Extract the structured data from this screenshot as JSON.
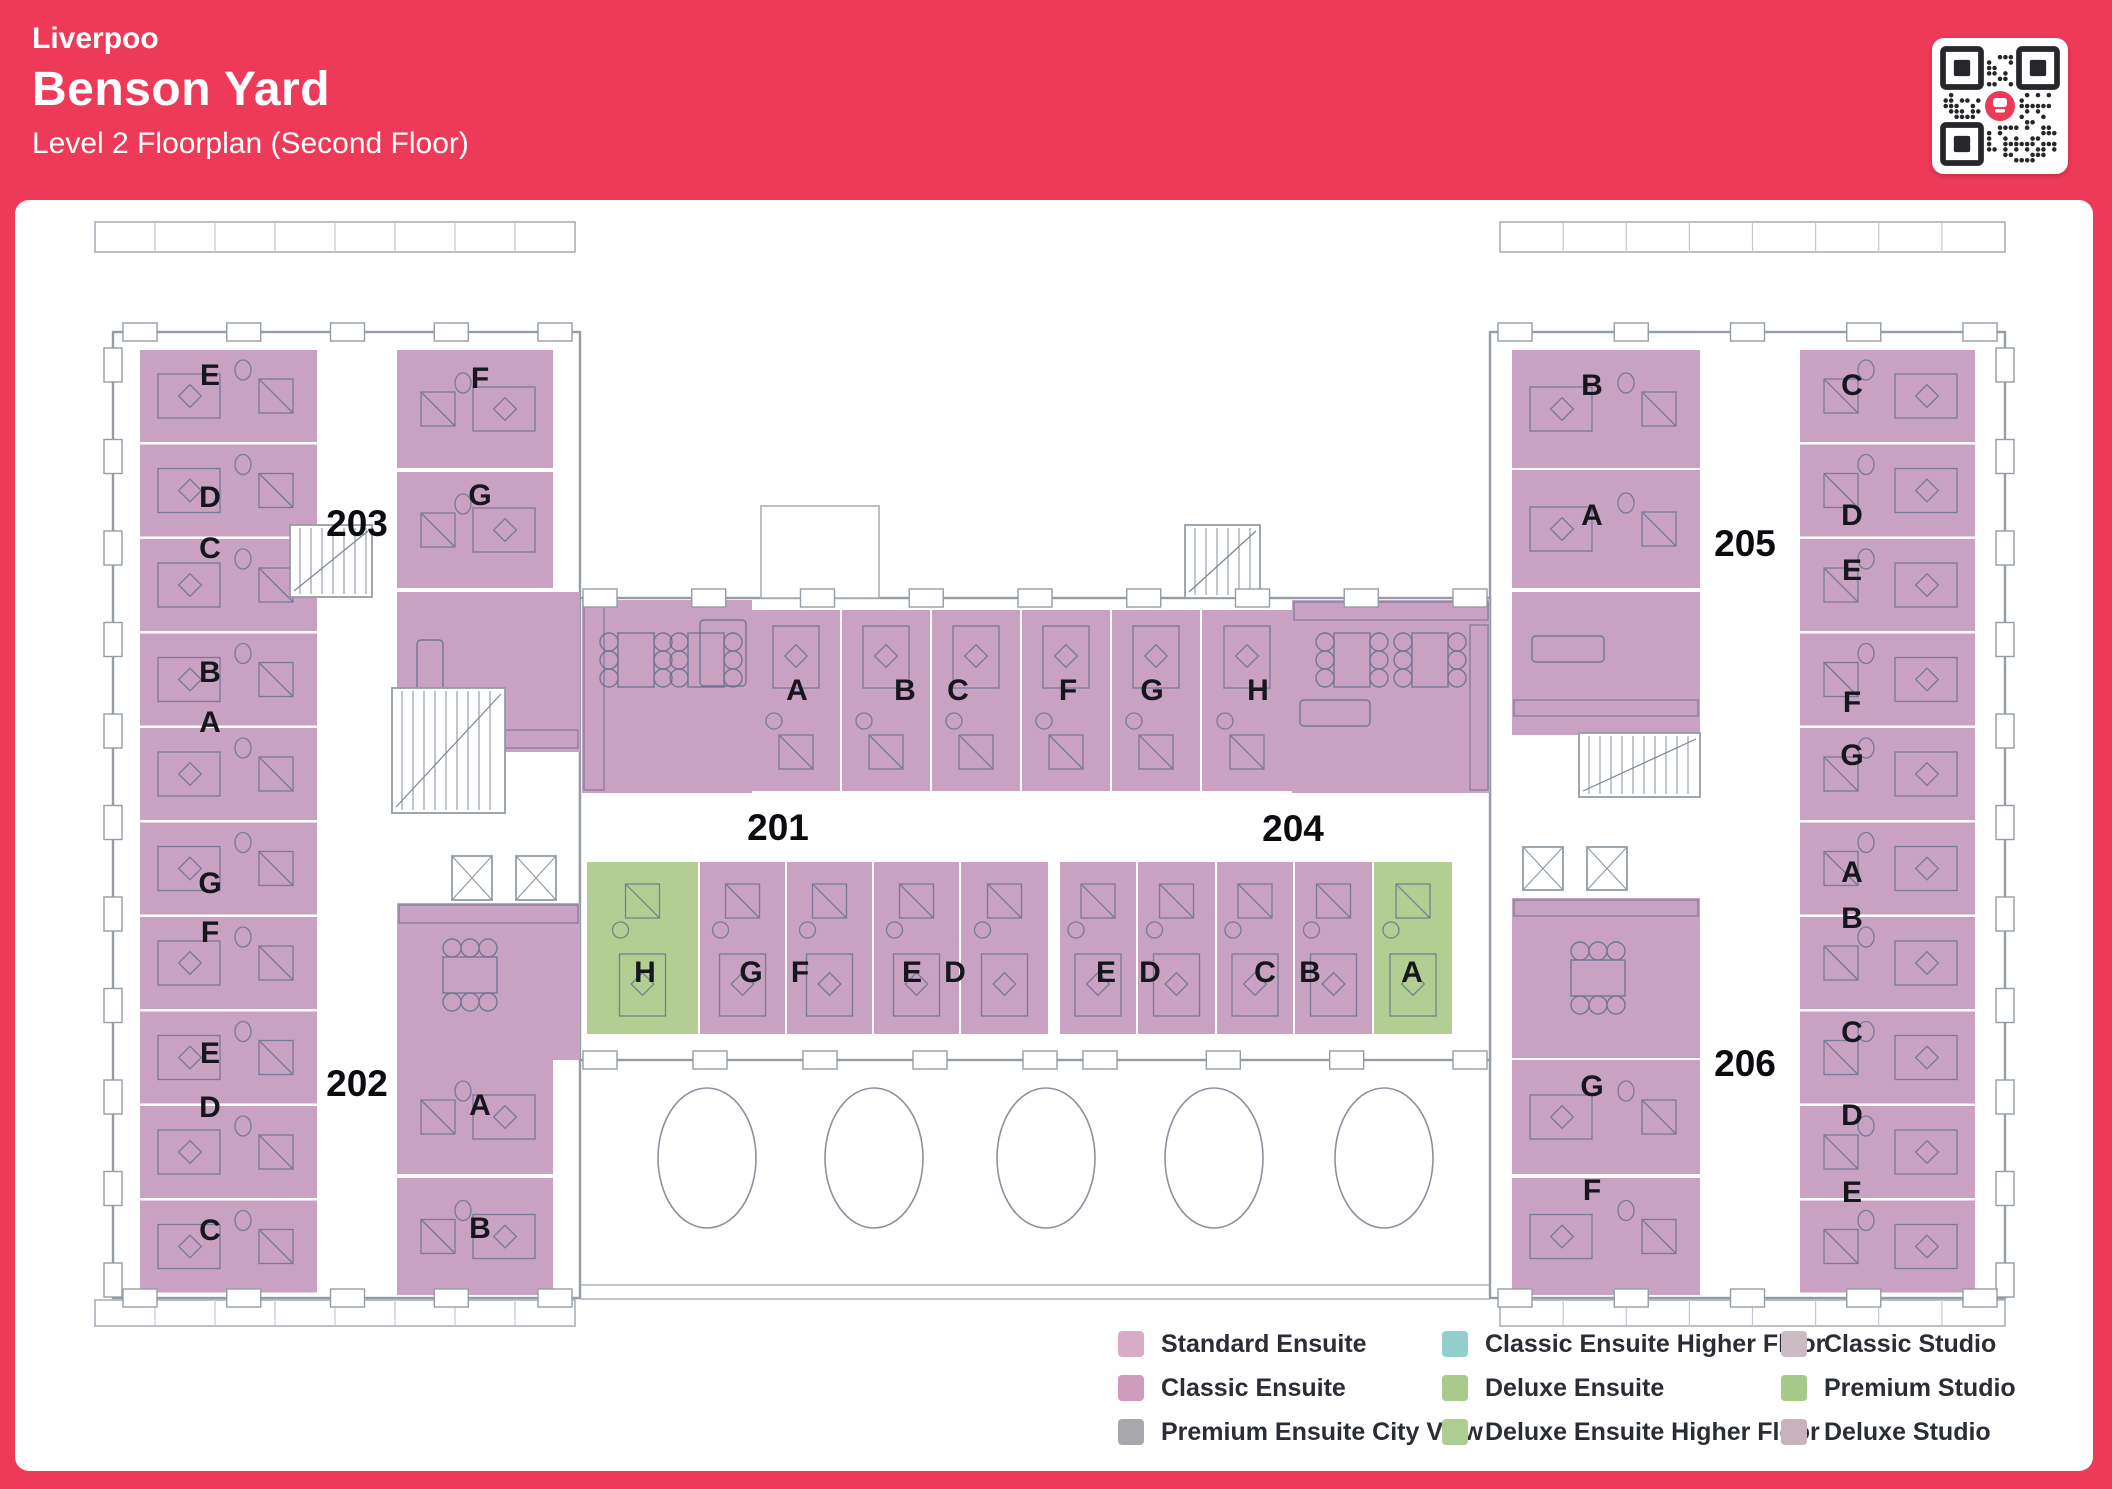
{
  "header": {
    "location": "Liverpoo",
    "building": "Benson Yard",
    "subtitle": "Level 2 Floorplan (Second Floor)"
  },
  "colors": {
    "page_red": "#ee3a59",
    "panel_white": "#ffffff",
    "room_pink": "#c9a1c1",
    "room_green": "#b4cd93",
    "wall_gray": "#949ca6",
    "furniture_line": "#5d6e89",
    "label_dark": "#16161d"
  },
  "qr": {
    "logo_color": "#ee3a59",
    "modules": 21
  },
  "legend": {
    "items": [
      {
        "label": "Standard Ensuite",
        "color": "#d8abc6"
      },
      {
        "label": "Classic Ensuite",
        "color": "#cf9cbd"
      },
      {
        "label": "Premium Ensuite City View",
        "color": "#a8a8ac"
      },
      {
        "label": "Classic Ensuite Higher Floor",
        "color": "#92cfca"
      },
      {
        "label": "Deluxe Ensuite",
        "color": "#a9ca8b"
      },
      {
        "label": "Deluxe Ensuite Higher Floor",
        "color": "#aecd92"
      },
      {
        "label": "Classic Studio",
        "color": "#cbbcc4"
      },
      {
        "label": "Premium Studio",
        "color": "#a5c987"
      },
      {
        "label": "Deluxe Studio",
        "color": "#c6b3bd"
      }
    ]
  },
  "plan": {
    "flat_labels": [
      {
        "t": "203",
        "x": 357,
        "y": 536
      },
      {
        "t": "202",
        "x": 357,
        "y": 1096
      },
      {
        "t": "201",
        "x": 778,
        "y": 840
      },
      {
        "t": "204",
        "x": 1293,
        "y": 841
      },
      {
        "t": "205",
        "x": 1745,
        "y": 556
      },
      {
        "t": "206",
        "x": 1745,
        "y": 1076
      }
    ],
    "wings": [
      {
        "x": 113,
        "y": 332,
        "w": 467,
        "h": 966
      },
      {
        "x": 1490,
        "y": 332,
        "w": 515,
        "h": 966
      },
      {
        "x": 580,
        "y": 598,
        "w": 910,
        "h": 462
      }
    ],
    "parapets": [
      {
        "x": 95,
        "y": 222,
        "w": 480,
        "h": 30
      },
      {
        "x": 1500,
        "y": 222,
        "w": 505,
        "h": 30
      },
      {
        "x": 95,
        "y": 1300,
        "w": 480,
        "h": 26
      },
      {
        "x": 1500,
        "y": 1300,
        "w": 505,
        "h": 26
      }
    ],
    "bridges": [
      {
        "x": 761,
        "y": 506,
        "w": 118,
        "h": 92
      }
    ],
    "window_bands": [
      {
        "dir": "v",
        "x": 113,
        "y1": 365,
        "y2": 1280,
        "n": 11
      },
      {
        "dir": "v",
        "x": 2005,
        "y1": 365,
        "y2": 1280,
        "n": 11
      },
      {
        "dir": "h",
        "y": 332,
        "x1": 140,
        "x2": 555,
        "n": 5
      },
      {
        "dir": "h",
        "y": 332,
        "x1": 1515,
        "x2": 1980,
        "n": 5
      },
      {
        "dir": "h",
        "y": 1298,
        "x1": 140,
        "x2": 555,
        "n": 5
      },
      {
        "dir": "h",
        "y": 1298,
        "x1": 1515,
        "x2": 1980,
        "n": 5
      },
      {
        "dir": "h",
        "y": 598,
        "x1": 600,
        "x2": 1470,
        "n": 9
      },
      {
        "dir": "h",
        "y": 1060,
        "x1": 600,
        "x2": 1040,
        "n": 5
      },
      {
        "dir": "h",
        "y": 1060,
        "x1": 1100,
        "x2": 1470,
        "n": 4
      }
    ],
    "rooms": [
      {
        "l": "E",
        "x": 140,
        "y": 350,
        "w": 177,
        "h": 92,
        "f": "p",
        "pod": "r",
        "lx": 210,
        "ly": 385
      },
      {
        "l": "D",
        "x": 140,
        "y": 444.5,
        "w": 177,
        "h": 92,
        "f": "p",
        "pod": "r",
        "lx": 210,
        "ly": 507
      },
      {
        "l": "C",
        "x": 140,
        "y": 539,
        "w": 177,
        "h": 92,
        "f": "p",
        "pod": "r",
        "lx": 210,
        "ly": 558
      },
      {
        "l": "B",
        "x": 140,
        "y": 633.5,
        "w": 177,
        "h": 92,
        "f": "p",
        "pod": "r",
        "lx": 210,
        "ly": 682
      },
      {
        "l": "A",
        "x": 140,
        "y": 728,
        "w": 177,
        "h": 92,
        "f": "p",
        "pod": "r",
        "lx": 210,
        "ly": 732
      },
      {
        "l": "G",
        "x": 140,
        "y": 822.5,
        "w": 177,
        "h": 92,
        "f": "p",
        "pod": "r",
        "lx": 210,
        "ly": 893
      },
      {
        "l": "F",
        "x": 140,
        "y": 917,
        "w": 177,
        "h": 92,
        "f": "p",
        "pod": "r",
        "lx": 210,
        "ly": 942
      },
      {
        "l": "E",
        "x": 140,
        "y": 1011.5,
        "w": 177,
        "h": 92,
        "f": "p",
        "pod": "r",
        "lx": 210,
        "ly": 1063
      },
      {
        "l": "D",
        "x": 140,
        "y": 1106,
        "w": 177,
        "h": 92,
        "f": "p",
        "pod": "r",
        "lx": 210,
        "ly": 1117
      },
      {
        "l": "C",
        "x": 140,
        "y": 1200.5,
        "w": 177,
        "h": 92,
        "f": "p",
        "pod": "r",
        "lx": 210,
        "ly": 1240
      },
      {
        "l": "C",
        "x": 1800,
        "y": 350,
        "w": 175,
        "h": 92,
        "f": "p",
        "pod": "l",
        "lx": 1852,
        "ly": 395
      },
      {
        "l": "D",
        "x": 1800,
        "y": 444.5,
        "w": 175,
        "h": 92,
        "f": "p",
        "pod": "l",
        "lx": 1852,
        "ly": 525
      },
      {
        "l": "E",
        "x": 1800,
        "y": 539,
        "w": 175,
        "h": 92,
        "f": "p",
        "pod": "l",
        "lx": 1852,
        "ly": 580
      },
      {
        "l": "F",
        "x": 1800,
        "y": 633.5,
        "w": 175,
        "h": 92,
        "f": "p",
        "pod": "l",
        "lx": 1852,
        "ly": 712
      },
      {
        "l": "G",
        "x": 1800,
        "y": 728,
        "w": 175,
        "h": 92,
        "f": "p",
        "pod": "l",
        "lx": 1852,
        "ly": 765
      },
      {
        "l": "A",
        "x": 1800,
        "y": 822.5,
        "w": 175,
        "h": 92,
        "f": "p",
        "pod": "l",
        "lx": 1852,
        "ly": 882
      },
      {
        "l": "B",
        "x": 1800,
        "y": 917,
        "w": 175,
        "h": 92,
        "f": "p",
        "pod": "l",
        "lx": 1852,
        "ly": 928
      },
      {
        "l": "C",
        "x": 1800,
        "y": 1011.5,
        "w": 175,
        "h": 92,
        "f": "p",
        "pod": "l",
        "lx": 1852,
        "ly": 1042
      },
      {
        "l": "D",
        "x": 1800,
        "y": 1106,
        "w": 175,
        "h": 92,
        "f": "p",
        "pod": "l",
        "lx": 1852,
        "ly": 1125
      },
      {
        "l": "E",
        "x": 1800,
        "y": 1200.5,
        "w": 175,
        "h": 92,
        "f": "p",
        "pod": "l",
        "lx": 1852,
        "ly": 1202
      },
      {
        "l": "F",
        "x": 397,
        "y": 350,
        "w": 156,
        "h": 118,
        "f": "p",
        "pod": "l",
        "lx": 480,
        "ly": 388
      },
      {
        "l": "G",
        "x": 397,
        "y": 472,
        "w": 156,
        "h": 116,
        "f": "p",
        "pod": "l",
        "lx": 480,
        "ly": 505
      },
      {
        "l": "A",
        "x": 397,
        "y": 1060,
        "w": 156,
        "h": 114,
        "f": "p",
        "pod": "l",
        "lx": 480,
        "ly": 1115
      },
      {
        "l": "B",
        "x": 397,
        "y": 1178,
        "w": 156,
        "h": 117,
        "f": "p",
        "pod": "l",
        "lx": 480,
        "ly": 1238
      },
      {
        "l": "B",
        "x": 1512,
        "y": 350,
        "w": 188,
        "h": 118,
        "f": "p",
        "pod": "r",
        "lx": 1592,
        "ly": 395
      },
      {
        "l": "A",
        "x": 1512,
        "y": 470,
        "w": 188,
        "h": 118,
        "f": "p",
        "pod": "r",
        "lx": 1592,
        "ly": 525
      },
      {
        "l": "G",
        "x": 1512,
        "y": 1060,
        "w": 188,
        "h": 114,
        "f": "p",
        "pod": "r",
        "lx": 1592,
        "ly": 1096
      },
      {
        "l": "F",
        "x": 1512,
        "y": 1178,
        "w": 188,
        "h": 117,
        "f": "p",
        "pod": "r",
        "lx": 1592,
        "ly": 1200
      },
      {
        "l": "A",
        "x": 752,
        "y": 610,
        "w": 88,
        "h": 181,
        "f": "p",
        "pod": "b",
        "lx": 797,
        "ly": 700
      },
      {
        "l": "B",
        "x": 842,
        "y": 610,
        "w": 88,
        "h": 181,
        "f": "p",
        "pod": "b",
        "lx": 905,
        "ly": 700
      },
      {
        "l": "C",
        "x": 932,
        "y": 610,
        "w": 88,
        "h": 181,
        "f": "p",
        "pod": "b",
        "lx": 958,
        "ly": 700
      },
      {
        "l": "F",
        "x": 1022,
        "y": 610,
        "w": 88,
        "h": 181,
        "f": "p",
        "pod": "b",
        "lx": 1068,
        "ly": 700
      },
      {
        "l": "G",
        "x": 1112,
        "y": 610,
        "w": 88,
        "h": 181,
        "f": "p",
        "pod": "b",
        "lx": 1152,
        "ly": 700
      },
      {
        "l": "H",
        "x": 1202,
        "y": 610,
        "w": 90,
        "h": 181,
        "f": "p",
        "pod": "b",
        "lx": 1258,
        "ly": 700
      },
      {
        "l": "H",
        "x": 587,
        "y": 862,
        "w": 111,
        "h": 172,
        "f": "g",
        "pod": "t",
        "lx": 645,
        "ly": 982
      },
      {
        "l": "G",
        "x": 700,
        "y": 862,
        "w": 85,
        "h": 172,
        "f": "p",
        "pod": "t",
        "lx": 751,
        "ly": 982
      },
      {
        "l": "F",
        "x": 787,
        "y": 862,
        "w": 85,
        "h": 172,
        "f": "p",
        "pod": "t",
        "lx": 800,
        "ly": 982
      },
      {
        "l": "E",
        "x": 874,
        "y": 862,
        "w": 85,
        "h": 172,
        "f": "p",
        "pod": "t",
        "lx": 912,
        "ly": 982
      },
      {
        "l": "D",
        "x": 961,
        "y": 862,
        "w": 87,
        "h": 172,
        "f": "p",
        "pod": "t",
        "lx": 955,
        "ly": 982
      },
      {
        "l": "E",
        "x": 1060,
        "y": 862,
        "w": 76,
        "h": 172,
        "f": "p",
        "pod": "t",
        "lx": 1106,
        "ly": 982
      },
      {
        "l": "D",
        "x": 1138,
        "y": 862,
        "w": 77,
        "h": 172,
        "f": "p",
        "pod": "t",
        "lx": 1150,
        "ly": 982
      },
      {
        "l": "C",
        "x": 1217,
        "y": 862,
        "w": 76,
        "h": 172,
        "f": "p",
        "pod": "t",
        "lx": 1265,
        "ly": 982
      },
      {
        "l": "B",
        "x": 1295,
        "y": 862,
        "w": 77,
        "h": 172,
        "f": "p",
        "pod": "t",
        "lx": 1310,
        "ly": 982
      },
      {
        "l": "A",
        "x": 1374,
        "y": 862,
        "w": 78,
        "h": 172,
        "f": "g",
        "pod": "t",
        "lx": 1412,
        "ly": 982
      }
    ],
    "communal": [
      {
        "x": 397,
        "y": 592,
        "w": 183,
        "h": 160
      },
      {
        "x": 397,
        "y": 903,
        "w": 183,
        "h": 157
      },
      {
        "x": 582,
        "y": 600,
        "w": 170,
        "h": 193
      },
      {
        "x": 1292,
        "y": 600,
        "w": 198,
        "h": 193
      },
      {
        "x": 1512,
        "y": 592,
        "w": 188,
        "h": 143
      },
      {
        "x": 1512,
        "y": 898,
        "w": 188,
        "h": 160
      }
    ],
    "counters": [
      {
        "x": 399,
        "y": 730,
        "w": 179,
        "h": 18
      },
      {
        "x": 399,
        "y": 905,
        "w": 179,
        "h": 18
      },
      {
        "x": 584,
        "y": 604,
        "w": 20,
        "h": 186
      },
      {
        "x": 1294,
        "y": 602,
        "w": 194,
        "h": 18
      },
      {
        "x": 1470,
        "y": 625,
        "w": 18,
        "h": 165
      },
      {
        "x": 1514,
        "y": 700,
        "w": 184,
        "h": 16
      },
      {
        "x": 1514,
        "y": 900,
        "w": 184,
        "h": 16
      }
    ],
    "tables": [
      {
        "x": 636,
        "y": 660
      },
      {
        "x": 706,
        "y": 660
      },
      {
        "x": 1352,
        "y": 660
      },
      {
        "x": 1430,
        "y": 660
      },
      {
        "x": 470,
        "y": 975,
        "horiz": true
      },
      {
        "x": 1598,
        "y": 978,
        "horiz": true
      }
    ],
    "sofas": [
      {
        "x": 417,
        "y": 640,
        "w": 26,
        "h": 74
      },
      {
        "x": 1532,
        "y": 636,
        "w": 72,
        "h": 26
      },
      {
        "x": 700,
        "y": 620,
        "w": 46,
        "h": 66
      },
      {
        "x": 1300,
        "y": 700,
        "w": 70,
        "h": 26
      }
    ],
    "stairs": [
      {
        "x": 290,
        "y": 525,
        "w": 82,
        "h": 72
      },
      {
        "x": 392,
        "y": 688,
        "w": 113,
        "h": 125
      },
      {
        "x": 1185,
        "y": 525,
        "w": 75,
        "h": 73
      },
      {
        "x": 1579,
        "y": 733,
        "w": 121,
        "h": 64
      }
    ],
    "elevators": [
      {
        "x": 452,
        "y": 856,
        "w": 40,
        "h": 44
      },
      {
        "x": 516,
        "y": 856,
        "w": 40,
        "h": 44
      },
      {
        "x": 1523,
        "y": 847,
        "w": 40,
        "h": 43
      },
      {
        "x": 1587,
        "y": 847,
        "w": 40,
        "h": 43
      }
    ],
    "courtyard": {
      "ellipses_cx": [
        707,
        874,
        1046,
        1214,
        1384
      ],
      "cy": 1158,
      "rx": 49,
      "ry": 70,
      "lines_y": [
        1285,
        1299
      ],
      "x1": 580,
      "x2": 1490
    }
  }
}
